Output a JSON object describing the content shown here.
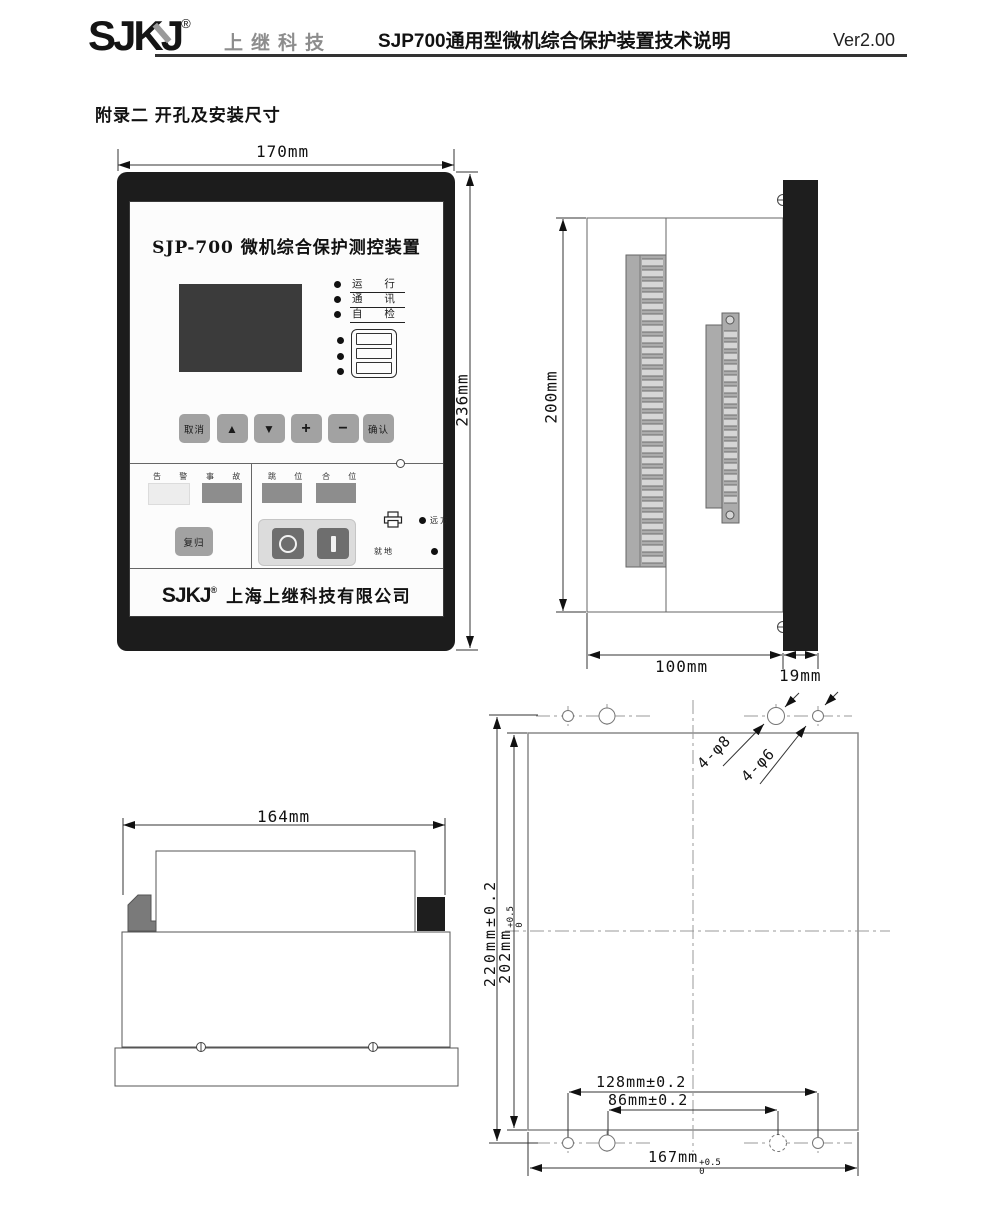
{
  "header": {
    "logo": "SJKJ",
    "reg": "®",
    "company": "上继科技",
    "title": "SJP700通用型微机综合保护装置技术说明",
    "version": "Ver2.00"
  },
  "section_title": "附录二 开孔及安装尺寸",
  "front_view": {
    "dim_width": "170mm",
    "dim_height": "236mm",
    "panel_title": "SJP-700  微机综合保护测控装置",
    "led_run": "运 行",
    "led_comm": "通 讯",
    "led_check": "自 检",
    "btn_cancel": "取消",
    "btn_up": "▲",
    "btn_down": "▼",
    "btn_plus": "+",
    "btn_minus": "−",
    "btn_confirm": "确认",
    "btn_reset": "复归",
    "lamp_alarm": "告 警",
    "lamp_fault": "事 故",
    "lamp_trip": "跳 位",
    "lamp_close": "合 位",
    "label_remote": "远方",
    "label_local": "就地",
    "footer_logo": "SJKJ",
    "footer_reg": "®",
    "footer_company": "上海上继科技有限公司"
  },
  "side_view": {
    "dim_height": "200mm",
    "dim_depth": "100mm",
    "dim_bezel": "19mm"
  },
  "bottom_view": {
    "dim_width": "164mm"
  },
  "cutout_view": {
    "dim_total_height": "220mm±0.2",
    "dim_cutout_height": "202mm",
    "dim_cutout_height_sup": "+0.5",
    "dim_cutout_height_sub": "0",
    "dim_hole_span_outer": "128mm±0.2",
    "dim_hole_span_inner": "86mm±0.2",
    "dim_cutout_width": "167mm",
    "dim_cutout_width_sup": "+0.5",
    "dim_cutout_width_sub": "0",
    "label_holes_large": "4-φ8",
    "label_holes_small": "4-φ6"
  }
}
